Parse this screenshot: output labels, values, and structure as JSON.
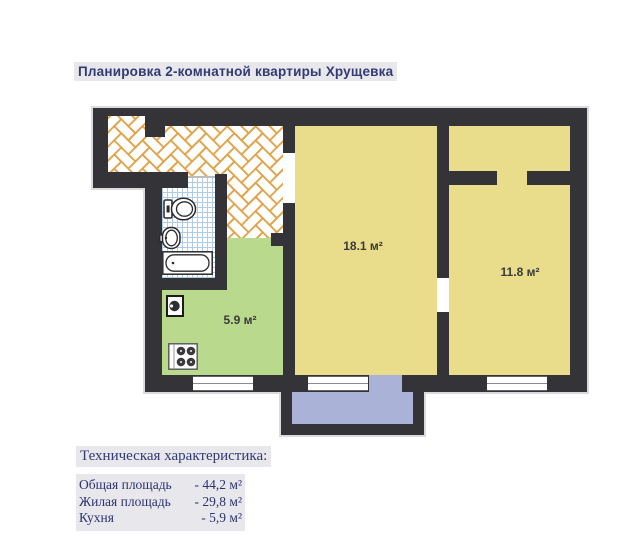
{
  "title": "Планировка 2-комнатной квартиры Хрущевка",
  "plan": {
    "rooms": {
      "living_area": "18.1 м²",
      "bedroom_area": "11.8 м²",
      "kitchen_area": "5.9 м²"
    },
    "icons": {
      "bathroom": [
        "toilet-icon",
        "wash-basin-icon",
        "bathtub-icon"
      ],
      "kitchen": [
        "washing-machine-icon",
        "stove-icon"
      ]
    },
    "colors": {
      "wall": "#333338",
      "room_fill": "#e9dc8b",
      "kitchen_fill": "#b9da8c",
      "balcony_fill": "#aab3d7",
      "parquet_line": "#e0a246",
      "tile_line": "#aecbe8",
      "heading_text": "#303a76",
      "highlight_bg": "#e7e7ec"
    }
  },
  "specs": {
    "heading": "Техническая характеристика:",
    "rows": [
      {
        "label": "Общая площадь",
        "value": "- 44,2 м²"
      },
      {
        "label": "Жилая площадь",
        "value": "- 29,8 м²"
      },
      {
        "label": "Кухня",
        "value": "- 5,9 м²"
      }
    ]
  }
}
